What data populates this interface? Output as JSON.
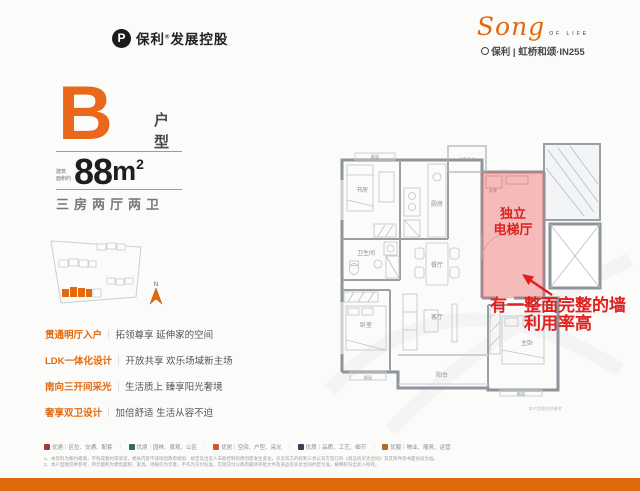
{
  "header": {
    "brand": {
      "icon": "P",
      "name": "保利",
      "reg": "®",
      "suffix": "发展控股"
    },
    "logo": {
      "script": "Song",
      "tagline": "OF LIFE",
      "project": "保利 | 虹桥和颂·IN255"
    }
  },
  "unit": {
    "letter": "B",
    "type": "户型",
    "area_label_1": "建筑",
    "area_label_2": "面积约",
    "area_value": "88",
    "area_unit": "m",
    "area_sup": "2",
    "rooms": "三房两厅两卫"
  },
  "siteplan": {
    "north": "N"
  },
  "features": {
    "sep": "｜",
    "items": [
      {
        "title": "贯通明厅入户",
        "desc": "拓领尊享 延伸家的空间"
      },
      {
        "title": "LDK一体化设计",
        "desc": "开放共享 欢乐场域新主场"
      },
      {
        "title": "南向三开间采光",
        "desc": "生活质上 臻享阳光奢境"
      },
      {
        "title": "奢享双卫设计",
        "desc": "加倍舒适 生活从容不迫"
      }
    ]
  },
  "plan": {
    "rooms": {
      "study": "书房",
      "kitchen": "厨房",
      "equipment": "设备平台",
      "bath": "卫生间",
      "dining": "餐厅",
      "living": "客厅",
      "balcony": "阳台",
      "bedroom": "卧室",
      "master": "主卧",
      "bay1": "飘窗",
      "bay2": "飘窗",
      "bay3": "飘窗",
      "entry": "玄关"
    },
    "highlight": {
      "line1": "独立",
      "line2": "电梯厅",
      "color": "#ED6E6E"
    },
    "annotation": {
      "line1": "有一整面完整的墙",
      "line2": "利用率高",
      "color": "#E01F1F"
    },
    "caption": "本户型图仅供参考"
  },
  "legend": {
    "sep": "｜",
    "items": [
      {
        "color": "#9E3B35",
        "label": "优遇｜区位、交通、配套"
      },
      {
        "color": "#2F6B5E",
        "label": "优境｜园林、景观、公区"
      },
      {
        "color": "#D4562A",
        "label": "优居｜空间、户型、采光"
      },
      {
        "color": "#394150",
        "label": "优质｜品质、工艺、细节"
      },
      {
        "color": "#B06A2E",
        "label": "优服｜物业、服务、运营"
      }
    ]
  },
  "disclaimer": {
    "line1": "1、本资料为要约邀请，不构成要约或承诺，相关内容不排除因政府规划、规定及出卖人未能控制的原因而发生变化，买卖双方的权利义务以双方签订的《商品房买卖合同》及其附件等书面协议为准。",
    "line2": "2、本户型图仅供参考，所示面积为建筑面积，家具、绿植仅为示意，不作为交付标准，实际交付以政府最终审批文件及商品房买卖合同约定为准，解释权归出卖人所有。"
  }
}
